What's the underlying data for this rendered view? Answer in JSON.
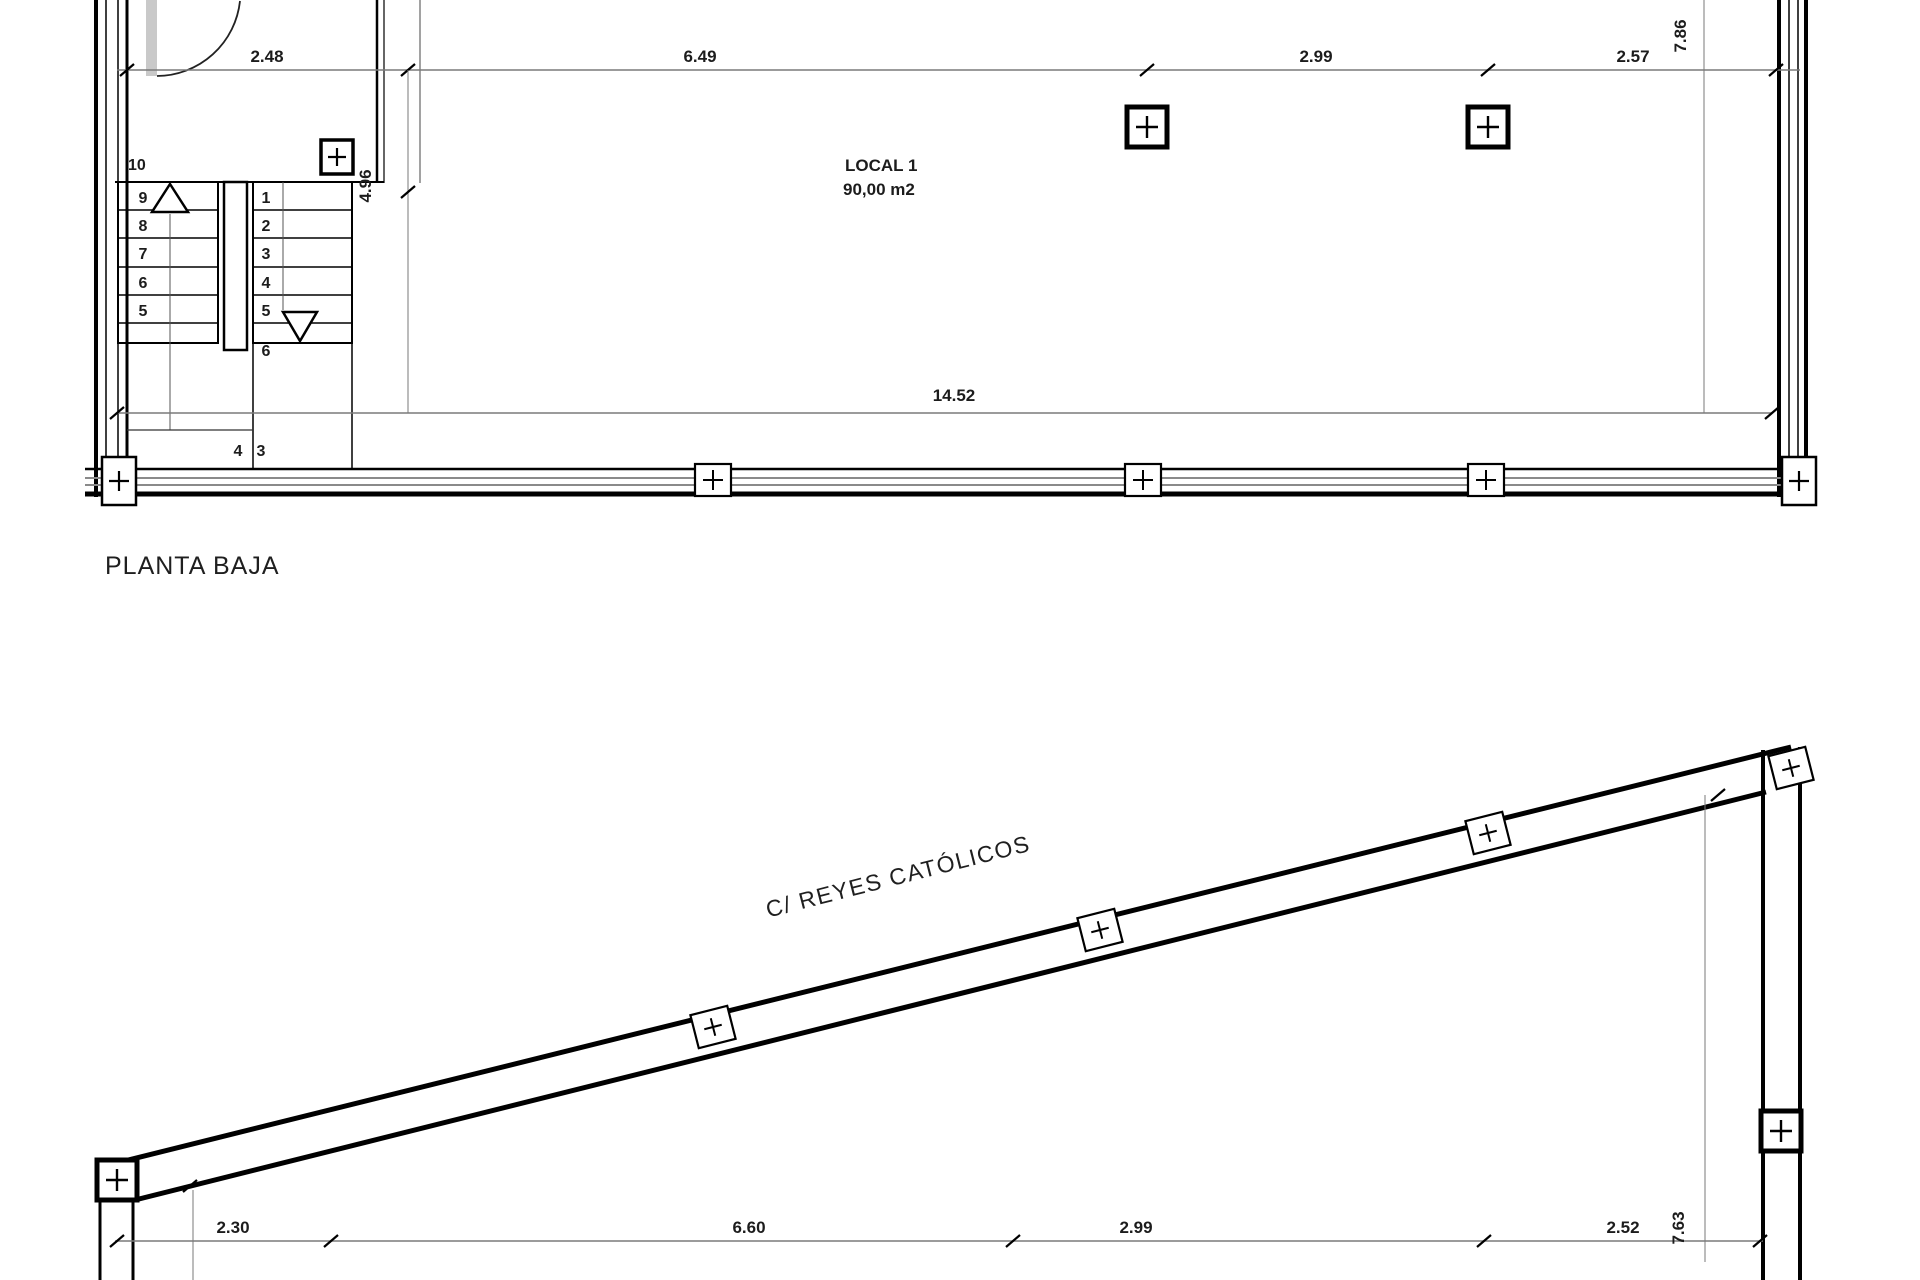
{
  "drawing": {
    "background": "#ffffff",
    "wall_color": "#000000",
    "dim_line_color": "#7a7a7a",
    "text_color": "#1c1c1c",
    "door_leaf_color": "#c9c9c9"
  },
  "planta_baja": {
    "title": "PLANTA BAJA",
    "room": {
      "name": "LOCAL 1",
      "area": "90,00 m2"
    },
    "dim_top_segments": [
      "2.48",
      "6.49",
      "2.99",
      "2.57"
    ],
    "dim_width_total": "14.52",
    "dim_height_total": "7.86",
    "dim_stair_bay": "4.96",
    "stair": {
      "top_step": "10",
      "up_flight": [
        "9",
        "8",
        "7",
        "6",
        "5"
      ],
      "down_flight": [
        "1",
        "2",
        "3",
        "4",
        "5",
        "6"
      ],
      "lower_labels": [
        "4",
        "3"
      ]
    }
  },
  "planta_calle": {
    "street_name": "C/ REYES CATÓLICOS",
    "dim_bottom_segments": [
      "2.30",
      "6.60",
      "2.99",
      "2.52"
    ],
    "dim_height_total": "7.63"
  }
}
